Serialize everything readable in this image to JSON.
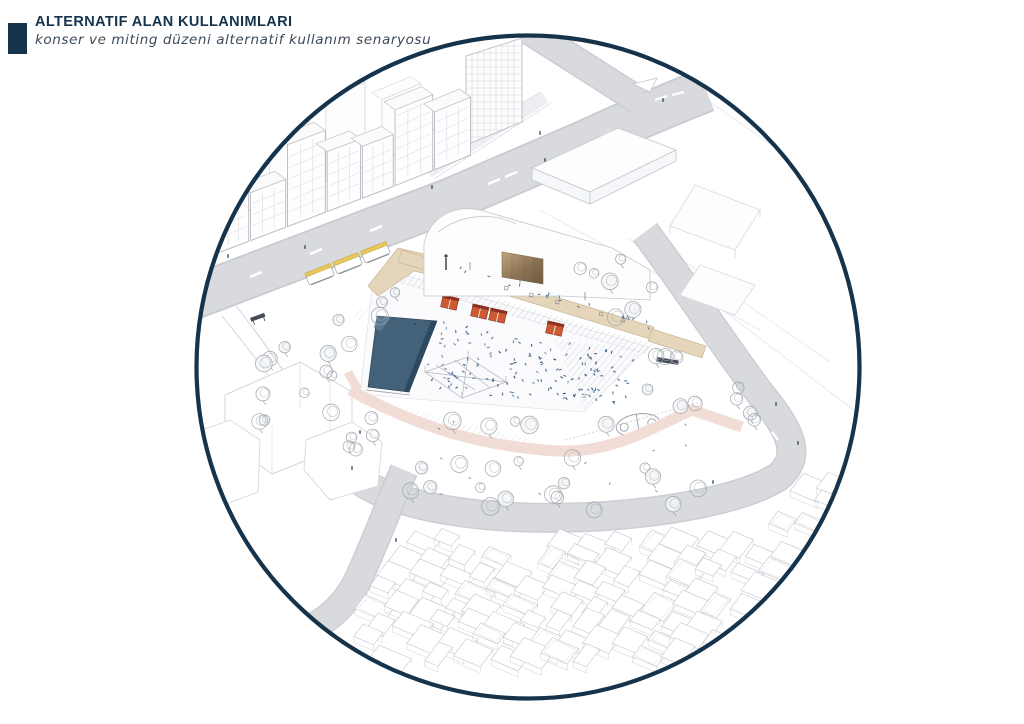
{
  "header": {
    "title": "ALTERNATIF ALAN KULLANIMLARI",
    "subtitle": "konser ve miting düzeni alternatif kullanım senaryosu"
  },
  "colors": {
    "accent_navy": "#16334c",
    "stage_blue": "#43627a",
    "stage_edge": "#2d4962",
    "kiosk_orange": "#cc5a33",
    "kiosk_roof_red": "#8c3220",
    "terrace_beige": "#e5d5ba",
    "walkway_pink": "#f1dcd6",
    "road_gray": "#d9dadd",
    "crowd_blue": "#2f5b86",
    "tram_yellow": "#e8c75a"
  }
}
